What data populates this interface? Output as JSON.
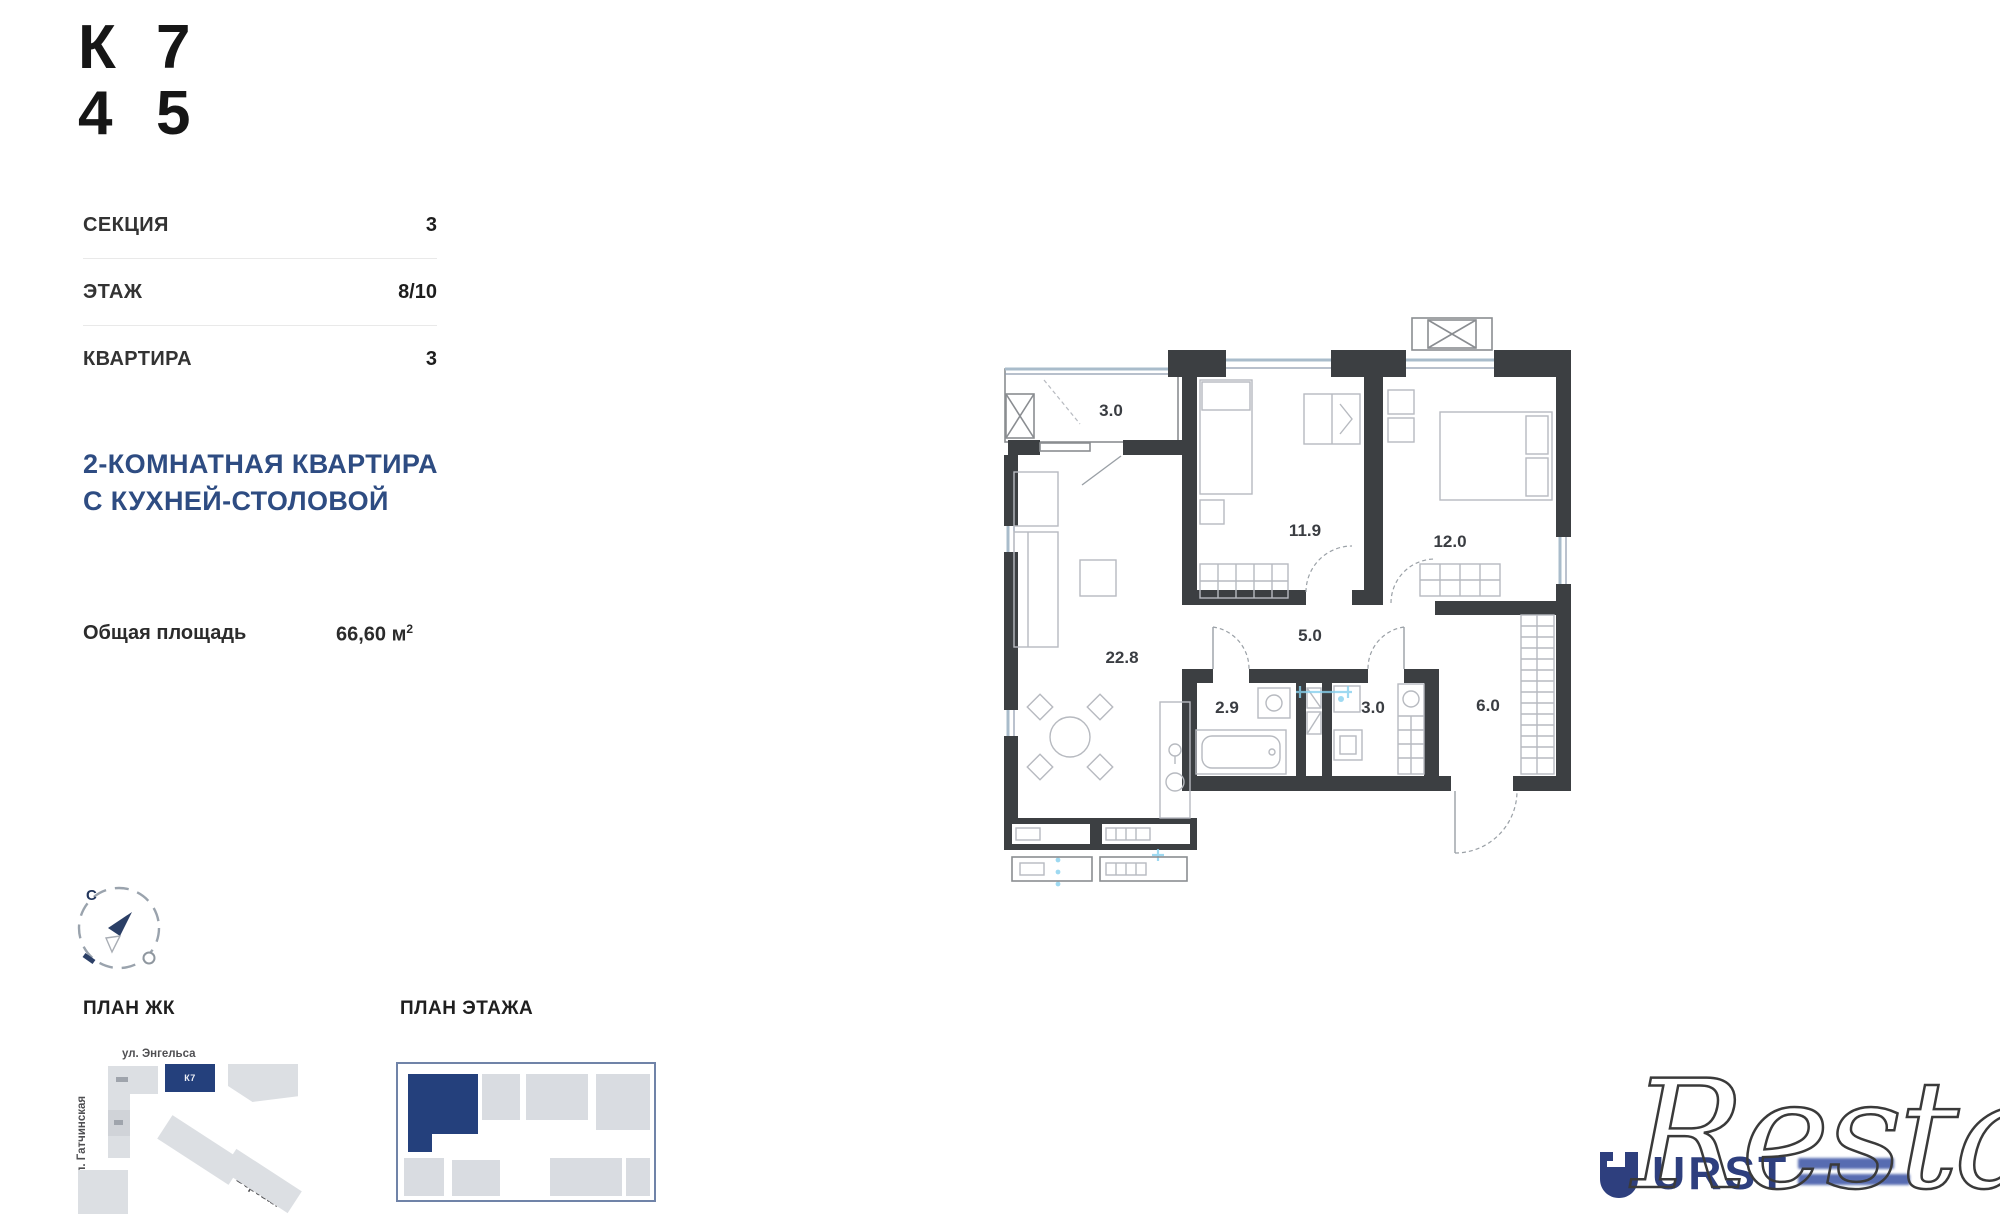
{
  "header": {
    "cells": [
      "К",
      "7",
      "4",
      "5"
    ]
  },
  "info": {
    "rows": [
      {
        "label": "СЕКЦИЯ",
        "value": "3"
      },
      {
        "label": "ЭТАЖ",
        "value": "8/10"
      },
      {
        "label": "КВАРТИРА",
        "value": "3"
      }
    ]
  },
  "title": {
    "line1": "2-КОМНАТНАЯ КВАРТИРА",
    "line2": "С КУХНЕЙ-СТОЛОВОЙ"
  },
  "area": {
    "label": "Общая площадь",
    "value": "66,60 м",
    "sup": "2"
  },
  "compass": {
    "north": "С"
  },
  "sections": {
    "plan_jk": "ПЛАН ЖК",
    "plan_floor": "ПЛАН ЭТАЖА"
  },
  "sitemap": {
    "street_top": "ул. Энгельса",
    "street_left": "ул. Гатчинская",
    "street_bottom": "ул. Боровая",
    "highlight": "К7"
  },
  "floorplan": {
    "rooms": [
      {
        "id": "balcony",
        "area": "3.0"
      },
      {
        "id": "kitchen-living",
        "area": "22.8"
      },
      {
        "id": "bedroom-1",
        "area": "11.9"
      },
      {
        "id": "bedroom-2",
        "area": "12.0"
      },
      {
        "id": "hall",
        "area": "5.0"
      },
      {
        "id": "bathroom",
        "area": "2.9"
      },
      {
        "id": "wc",
        "area": "3.0"
      },
      {
        "id": "entry",
        "area": "6.0"
      }
    ]
  },
  "branding": {
    "logo": "URST",
    "watermark": "Restate"
  },
  "colors": {
    "accent_navy": "#2e4c82",
    "wall": "#3c3f42",
    "window": "#a9bccb",
    "marker_blue": "#86d0ee",
    "map_gray": "#d9dce1",
    "map_navy": "#24407c"
  }
}
